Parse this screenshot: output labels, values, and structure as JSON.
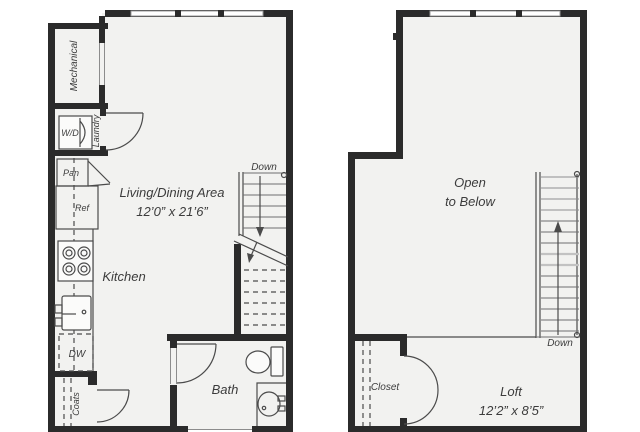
{
  "level1": {
    "mechanical_label": "Mechanical",
    "wd_label": "W/D",
    "laundry_label": "Laundry",
    "pantry_label": "Pan",
    "fridge_label": "Ref",
    "kitchen_label": "Kitchen",
    "living_area_label": "Living/Dining Area",
    "living_area_dims": "12’0” x 21’6”",
    "dishwasher_label": "DW",
    "coats_label": "Coats",
    "bath_label": "Bath",
    "stairs_label": "Down"
  },
  "level2": {
    "open_to_below_line1": "Open",
    "open_to_below_line2": "to Below",
    "loft_label": "Loft",
    "loft_dims": "12’2” x 8’5”",
    "closet_label": "Closet",
    "stairs_label": "Down"
  },
  "colors": {
    "wall": "#2b2b2b",
    "floor": "#f2f2f0",
    "line": "#4b4b4b",
    "text": "#3c3c3c",
    "tread": "#6f6f6f",
    "fixture": "#fbfbfa"
  }
}
